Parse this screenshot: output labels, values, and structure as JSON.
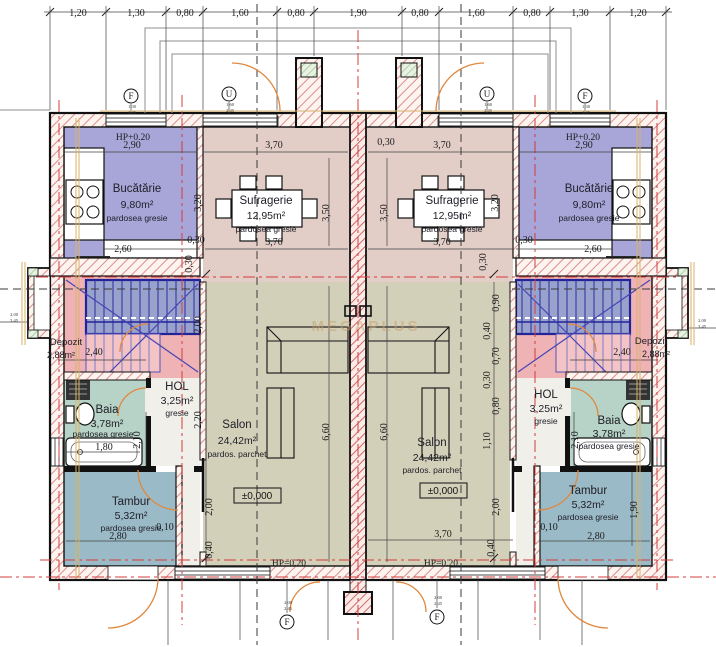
{
  "plan": {
    "watermark": "MEGAPLUS",
    "rooms": {
      "bucatarie": {
        "name": "Bucătărie",
        "area": "9,80m²",
        "floor": "pardosea gresie"
      },
      "sufragerie": {
        "name": "Sufragerie",
        "area": "12,95m²",
        "floor": "pardosea gresie"
      },
      "salon": {
        "name": "Salon",
        "area": "24,42m²",
        "floor": "pardos. parchet",
        "level": "±0,000"
      },
      "hol": {
        "name": "HOL",
        "area": "3,25m²",
        "floor": "gresie"
      },
      "baia": {
        "name": "Baia",
        "area": "3,78m²",
        "floor": "pardosea gresie"
      },
      "tambur": {
        "name": "Tambur",
        "area": "5,32m²",
        "floor": "pardosea gresie"
      },
      "depozit": {
        "name": "Depozit",
        "area": "2,88m²"
      }
    },
    "hp": {
      "top": "HP+0.20",
      "bottom": "HP=0.20"
    },
    "colors": {
      "kitchen": "#a8a5d8",
      "dining": "#e2cdc7",
      "salon": "#d3d0ba",
      "bath": "#b7d2c6",
      "tambur": "#9bbac7",
      "hall": "#f1efe9",
      "stairs_pink": "#efb2b5",
      "wall_hatch": "#d98f8f",
      "axis_red": "#d43c3c",
      "door_arc": "#e0883e"
    },
    "dimensions": [
      {
        "t": "1,20",
        "x": 78,
        "y": 16
      },
      {
        "t": "1,30",
        "x": 136,
        "y": 16
      },
      {
        "t": "0,80",
        "x": 185,
        "y": 16
      },
      {
        "t": "1,60",
        "x": 240,
        "y": 16
      },
      {
        "t": "0,80",
        "x": 296,
        "y": 16
      },
      {
        "t": "1,90",
        "x": 358,
        "y": 16
      },
      {
        "t": "0,80",
        "x": 420,
        "y": 16
      },
      {
        "t": "1,60",
        "x": 476,
        "y": 16
      },
      {
        "t": "0,80",
        "x": 532,
        "y": 16
      },
      {
        "t": "1,30",
        "x": 580,
        "y": 16
      },
      {
        "t": "1,20",
        "x": 638,
        "y": 16
      },
      {
        "t": "2,90",
        "x": 132,
        "y": 148
      },
      {
        "t": "3,70",
        "x": 274,
        "y": 148
      },
      {
        "t": "0,30",
        "x": 386,
        "y": 145
      },
      {
        "t": "3,70",
        "x": 442,
        "y": 148
      },
      {
        "t": "2,90",
        "x": 584,
        "y": 148
      },
      {
        "t": "2,60",
        "x": 123,
        "y": 252
      },
      {
        "t": "0,30",
        "x": 196,
        "y": 243
      },
      {
        "t": "3,70",
        "x": 274,
        "y": 245
      },
      {
        "t": "3,70",
        "x": 442,
        "y": 245
      },
      {
        "t": "0,30",
        "x": 524,
        "y": 243
      },
      {
        "t": "2,60",
        "x": 593,
        "y": 252
      },
      {
        "t": "3,20",
        "x": 201,
        "y": 203,
        "r": -90
      },
      {
        "t": "3,50",
        "x": 329,
        "y": 213,
        "r": -90
      },
      {
        "t": "3,50",
        "x": 387,
        "y": 213,
        "r": -90
      },
      {
        "t": "3,20",
        "x": 498,
        "y": 203,
        "r": -90
      },
      {
        "t": "0,30",
        "x": 192,
        "y": 264,
        "r": -90
      },
      {
        "t": "0,30",
        "x": 486,
        "y": 262,
        "r": -90
      },
      {
        "t": "2,40",
        "x": 94,
        "y": 355
      },
      {
        "t": "2,40",
        "x": 622,
        "y": 355
      },
      {
        "t": "2,00",
        "x": 201,
        "y": 325,
        "r": -90
      },
      {
        "t": "2,20",
        "x": 201,
        "y": 420,
        "r": -90
      },
      {
        "t": "2,00",
        "x": 212,
        "y": 507,
        "r": -90
      },
      {
        "t": "0,40",
        "x": 212,
        "y": 550,
        "r": -90
      },
      {
        "t": "0,90",
        "x": 499,
        "y": 303,
        "r": -90
      },
      {
        "t": "0,40",
        "x": 490,
        "y": 331,
        "r": -90
      },
      {
        "t": "0,70",
        "x": 499,
        "y": 356,
        "r": -90
      },
      {
        "t": "0,30",
        "x": 490,
        "y": 380,
        "r": -90
      },
      {
        "t": "0,80",
        "x": 499,
        "y": 406,
        "r": -90
      },
      {
        "t": "1,10",
        "x": 490,
        "y": 441,
        "r": -90
      },
      {
        "t": "2,00",
        "x": 499,
        "y": 507,
        "r": -90
      },
      {
        "t": "0,40",
        "x": 494,
        "y": 548,
        "r": -90
      },
      {
        "t": "6,60",
        "x": 329,
        "y": 432,
        "r": -90
      },
      {
        "t": "6,60",
        "x": 387,
        "y": 432,
        "r": -90
      },
      {
        "t": "1,80",
        "x": 104,
        "y": 450
      },
      {
        "t": "2,10",
        "x": 140,
        "y": 440,
        "r": -90
      },
      {
        "t": "2,10",
        "x": 578,
        "y": 440,
        "r": -90
      },
      {
        "t": "0,10",
        "x": 165,
        "y": 530
      },
      {
        "t": "2,80",
        "x": 118,
        "y": 539
      },
      {
        "t": "0,10",
        "x": 549,
        "y": 530
      },
      {
        "t": "2,80",
        "x": 596,
        "y": 539
      },
      {
        "t": "1,90",
        "x": 637,
        "y": 510,
        "r": -90
      },
      {
        "t": "3,70",
        "x": 443,
        "y": 537
      }
    ],
    "markers": [
      {
        "letter": "F",
        "x": 131,
        "y": 96,
        "top": "1.30",
        "bot": "2.45"
      },
      {
        "letter": "U",
        "x": 229,
        "y": 94,
        "top": "1.60",
        "bot": "2.45"
      },
      {
        "letter": "U",
        "x": 487,
        "y": 94,
        "top": "1.60",
        "bot": "2.45"
      },
      {
        "letter": "F",
        "x": 585,
        "y": 96,
        "top": "1.30",
        "bot": "2.45"
      },
      {
        "letter": "F",
        "x": 287,
        "y": 622,
        "top": "2.00",
        "bot": "2.45"
      },
      {
        "letter": "F",
        "x": 437,
        "y": 617,
        "top": "2.00",
        "bot": "2.45"
      }
    ],
    "side_levels": [
      {
        "top": "2.00",
        "bot": "3.45",
        "x": 14,
        "y": 316
      },
      {
        "top": "2.00",
        "bot": "3.45",
        "x": 702,
        "y": 322
      }
    ]
  }
}
